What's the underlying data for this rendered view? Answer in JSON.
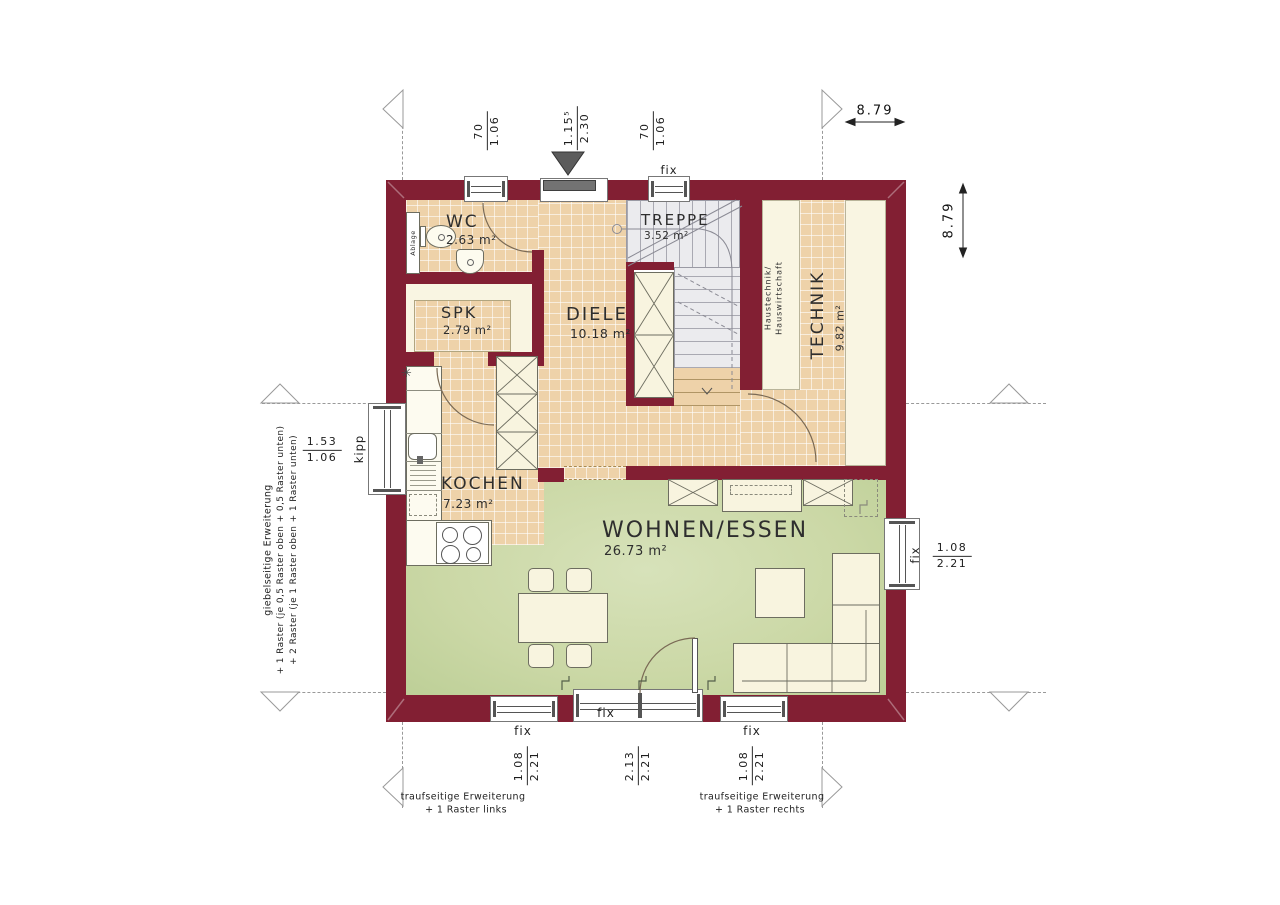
{
  "colors": {
    "wall": "#821f33",
    "tile_floor": "#eed2a9",
    "cream_floor": "#f9f5e2",
    "living_floor": "#cbd8a6",
    "stair_floor": "#ebebee"
  },
  "rooms": {
    "wc": {
      "name": "WC",
      "area": "2.63 m²"
    },
    "spk": {
      "name": "SPK",
      "area": "2.79 m²"
    },
    "diele": {
      "name": "DIELE",
      "area": "10.18 m²"
    },
    "treppe": {
      "name": "TREPPE",
      "area": "3.52 m²"
    },
    "technik": {
      "name": "TECHNIK",
      "area": "9.82 m²",
      "note1": "Haustechnik/",
      "note2": "Hauswirtschaft"
    },
    "kochen": {
      "name": "KOCHEN",
      "area": "7.23 m²"
    },
    "wohnen": {
      "name": "WOHNEN/ESSEN",
      "area": "26.73 m²"
    }
  },
  "labels": {
    "ablage": "Ablage",
    "fix": "fix",
    "kipp": "kipp",
    "asterisk": "✳"
  },
  "dims": {
    "top_left_window": {
      "num": "70",
      "den": "1.06"
    },
    "entrance": {
      "num": "1.15⁵",
      "den": "2.30"
    },
    "top_right_window": {
      "num": "70",
      "den": "1.06"
    },
    "total_width": "8.79",
    "total_height": "8.79",
    "left_window": {
      "num": "1.53",
      "den": "1.06"
    },
    "right_window": {
      "num": "1.08",
      "den": "2.21"
    },
    "bottom_left_window": {
      "num": "1.08",
      "den": "2.21"
    },
    "bottom_middle_window": {
      "num": "2.13",
      "den": "2.21"
    },
    "bottom_right_window": {
      "num": "1.08",
      "den": "2.21"
    }
  },
  "annotations": {
    "left_line1": "giebelseitige Erweiterung",
    "left_line2": "+ 1 Raster (je 0,5 Raster oben + 0,5 Raster unten)",
    "left_line3": "+ 2 Raster (je 1 Raster oben + 1 Raster unten)",
    "bottom_left_line1": "traufseitige Erweiterung",
    "bottom_left_line2": "+ 1 Raster links",
    "bottom_right_line1": "traufseitige Erweiterung",
    "bottom_right_line2": "+ 1 Raster rechts"
  }
}
